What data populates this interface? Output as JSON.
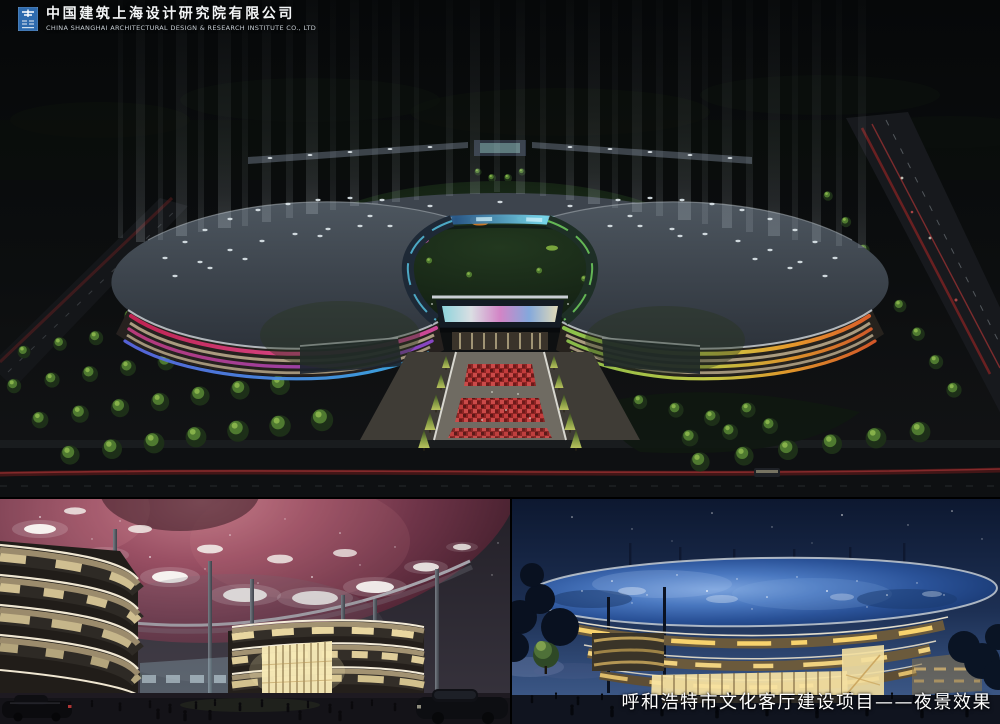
{
  "brand": {
    "logo_icon": "company-logo-icon",
    "company_cn": "中国建筑上海设计研究院有限公司",
    "company_en": "CHINA SHANGHAI ARCHITECTURAL DESIGN & RESEARCH INSTITUTE CO., LTD"
  },
  "caption": {
    "text": "呼和浩特市文化客厅建设项目——夜景效果"
  },
  "colors": {
    "logo_blue": "#2e6bae",
    "beam_white": "#dfe8ec",
    "ring_glass_cyan": "#62c8e8",
    "band_red": "#d23b66",
    "band_magenta": "#d857a8",
    "band_blue": "#4a7ae0",
    "band_cyan": "#38b2e6",
    "band_green": "#8cc84e",
    "band_orange": "#f09a28",
    "red_pavement": "#b42828",
    "nebula_pink": "#9a5064",
    "starry_blue": "#2c5498",
    "facade_gold": "#ffd970",
    "caption_white": "#ffffff"
  }
}
